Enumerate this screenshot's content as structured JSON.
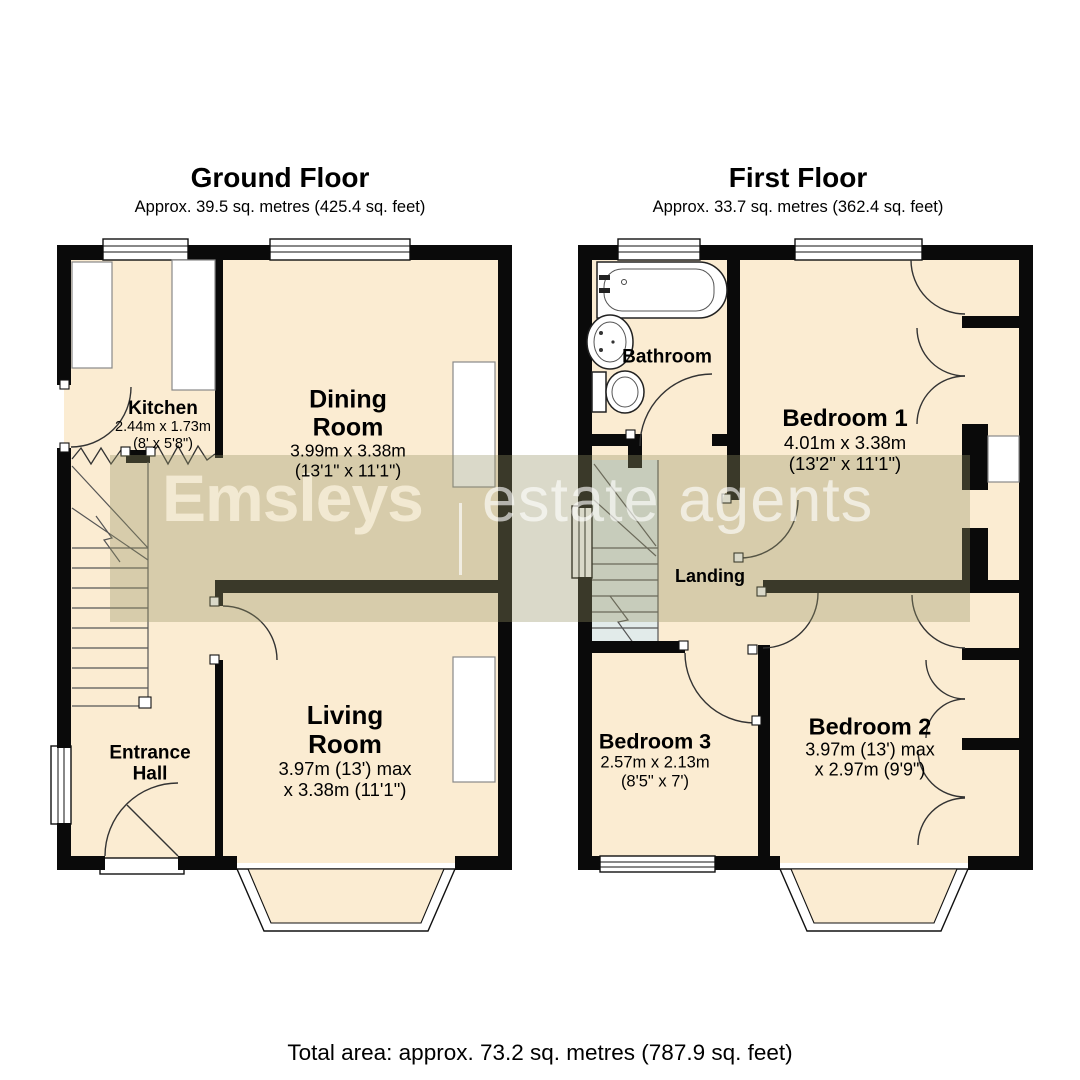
{
  "ground_floor": {
    "title": "Ground Floor",
    "subtitle": "Approx. 39.5 sq. metres (425.4 sq. feet)"
  },
  "first_floor": {
    "title": "First Floor",
    "subtitle": "Approx. 33.7 sq. metres (362.4 sq. feet)"
  },
  "rooms": {
    "kitchen": {
      "name": "Kitchen",
      "size_m": "2.44m x 1.73m",
      "size_ft": "(8' x 5'8\")"
    },
    "dining": {
      "name": "Dining Room",
      "size_m": "3.99m x 3.38m",
      "size_ft": "(13'1\" x 11'1\")"
    },
    "living": {
      "name": "Living Room",
      "size_m": "3.97m (13') max",
      "size_ft": "x 3.38m (11'1\")"
    },
    "entrance_hall": {
      "name": "Entrance Hall"
    },
    "bathroom": {
      "name": "Bathroom"
    },
    "bedroom1": {
      "name": "Bedroom 1",
      "size_m": "4.01m x 3.38m",
      "size_ft": "(13'2\" x 11'1\")"
    },
    "landing": {
      "name": "Landing"
    },
    "bedroom2": {
      "name": "Bedroom 2",
      "size_m": "3.97m (13') max",
      "size_ft": "x 2.97m (9'9\")"
    },
    "bedroom3": {
      "name": "Bedroom 3",
      "size_m": "2.57m x 2.13m",
      "size_ft": "(8'5\" x 7')"
    }
  },
  "watermark": {
    "brand": "Emsleys",
    "tagline": "estate agents"
  },
  "footer": {
    "total_area": "Total area: approx. 73.2 sq. metres (787.9 sq. feet)"
  },
  "colors": {
    "wall": "#0a0a0a",
    "room_fill": "#fbecd2",
    "stair_fill": "#e2ebea",
    "band": "rgba(150,147,100,0.35)",
    "brand_color": "#f2e9d2",
    "tagline_color": "rgba(255,255,255,0.62)",
    "text": "#000000"
  }
}
